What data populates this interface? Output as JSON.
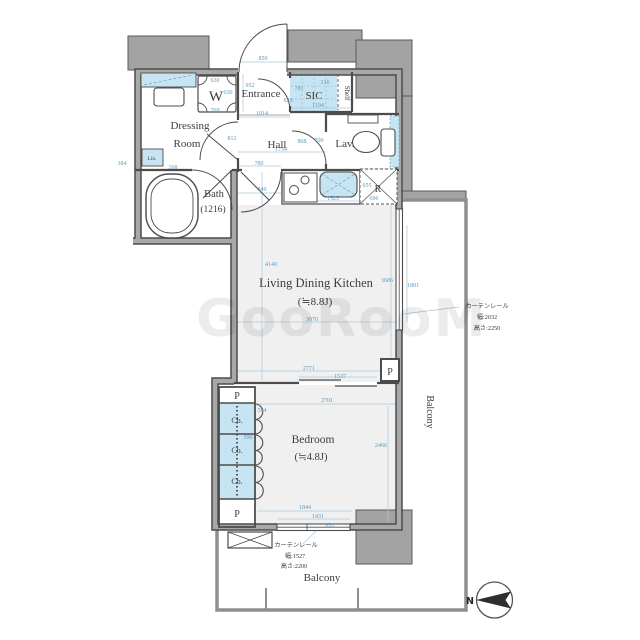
{
  "watermark": {
    "text": "GooRooM"
  },
  "colors": {
    "wall_edge": "#4c4c4c",
    "wall_fill": "#a8a8a8",
    "gray_block": "#a3a3a3",
    "fixture_blue": "#c7e4f2",
    "room_fill": "#f0f0f0",
    "dim_blue": "#5f98bc",
    "label_gray": "#3d3d3d",
    "balcony_line": "#8f8f8f"
  },
  "room_labels": [
    {
      "id": "entrance-label",
      "text": "Entrance",
      "x": 261,
      "y": 97,
      "size": 11
    },
    {
      "id": "sic-label",
      "text": "SIC",
      "x": 314,
      "y": 99,
      "size": 11
    },
    {
      "id": "shelf-label",
      "text": "Shelf",
      "x": 345,
      "y": 93,
      "size": 7,
      "rot": 90
    },
    {
      "id": "washer-label",
      "text": "W",
      "x": 216,
      "y": 101,
      "size": 15
    },
    {
      "id": "dressing-room-label-1",
      "text": "Dressing",
      "x": 190,
      "y": 129,
      "size": 11
    },
    {
      "id": "dressing-room-label-2",
      "text": "Room",
      "x": 187,
      "y": 147,
      "size": 11
    },
    {
      "id": "hall-label",
      "text": "Hall",
      "x": 277,
      "y": 148,
      "size": 11
    },
    {
      "id": "lavatory-label",
      "text": "Lav.",
      "x": 345,
      "y": 147,
      "size": 11
    },
    {
      "id": "linen-label",
      "text": "Lin.",
      "x": 152,
      "y": 160,
      "size": 5.5
    },
    {
      "id": "bath-label-1",
      "text": "Bath",
      "x": 214,
      "y": 197,
      "size": 10.5
    },
    {
      "id": "bath-label-2",
      "text": "(1216)",
      "x": 213,
      "y": 212,
      "size": 9.5
    },
    {
      "id": "ldk-label-1",
      "text": "Living Dining Kitchen",
      "x": 316,
      "y": 287,
      "size": 12.5
    },
    {
      "id": "ldk-label-2",
      "text": "(≒8.8J)",
      "x": 315,
      "y": 305,
      "size": 11
    },
    {
      "id": "bedroom-label-1",
      "text": "Bedroom",
      "x": 313,
      "y": 443,
      "size": 11.5
    },
    {
      "id": "bedroom-label-2",
      "text": "(≒4.8J)",
      "x": 311,
      "y": 460,
      "size": 10.5
    },
    {
      "id": "closet-label-1",
      "text": "Cb.",
      "x": 237,
      "y": 423,
      "size": 8
    },
    {
      "id": "closet-label-2",
      "text": "Cb.",
      "x": 237,
      "y": 453,
      "size": 8
    },
    {
      "id": "closet-label-3",
      "text": "Cb.",
      "x": 237,
      "y": 484,
      "size": 8
    },
    {
      "id": "pipe-space-ldk-label",
      "text": "P",
      "x": 390,
      "y": 375,
      "size": 10
    },
    {
      "id": "pipe-space-top-label",
      "text": "P",
      "x": 237,
      "y": 399,
      "size": 10
    },
    {
      "id": "pipe-space-bottom-label",
      "text": "P",
      "x": 237,
      "y": 517,
      "size": 10
    },
    {
      "id": "refrigerator-label",
      "text": "R",
      "x": 378,
      "y": 192,
      "size": 10
    },
    {
      "id": "balcony-right-label",
      "text": "Balcony",
      "x": 427,
      "y": 412,
      "size": 10,
      "rot": 90
    },
    {
      "id": "balcony-bottom-label",
      "text": "Balcony",
      "x": 322,
      "y": 581,
      "size": 11
    },
    {
      "id": "curtain-rail-right-1",
      "text": "カーテンレール",
      "x": 487,
      "y": 308,
      "size": 6.2
    },
    {
      "id": "curtain-rail-right-2",
      "text": "幅:2032",
      "x": 487,
      "y": 319,
      "size": 6.2
    },
    {
      "id": "curtain-rail-right-3",
      "text": "高さ:2250",
      "x": 487,
      "y": 330,
      "size": 6.2
    },
    {
      "id": "curtain-rail-bottom-1",
      "text": "カーテンレール",
      "x": 296,
      "y": 547,
      "size": 6.2
    },
    {
      "id": "curtain-rail-bottom-2",
      "text": "幅:1527",
      "x": 295,
      "y": 558,
      "size": 6.2
    },
    {
      "id": "curtain-rail-bottom-3",
      "text": "高さ:2200",
      "x": 294,
      "y": 568,
      "size": 6.2
    },
    {
      "id": "north-label",
      "text": "N",
      "x": 470,
      "y": 604,
      "size": 9.5,
      "cls": "north-lbl"
    }
  ],
  "dimensions": [
    {
      "v": "850",
      "x": 263,
      "y": 60
    },
    {
      "v": "952",
      "x": 250,
      "y": 87
    },
    {
      "v": "630",
      "x": 215,
      "y": 82
    },
    {
      "v": "630",
      "x": 228,
      "y": 94
    },
    {
      "v": "769",
      "x": 215,
      "y": 112
    },
    {
      "v": "781",
      "x": 299,
      "y": 90
    },
    {
      "v": "316",
      "x": 325,
      "y": 84
    },
    {
      "v": "629",
      "x": 288,
      "y": 102
    },
    {
      "v": "1194",
      "x": 318,
      "y": 107
    },
    {
      "v": "1014",
      "x": 262,
      "y": 115
    },
    {
      "v": "812",
      "x": 232,
      "y": 140
    },
    {
      "v": "868",
      "x": 302,
      "y": 143
    },
    {
      "v": "700",
      "x": 319,
      "y": 142
    },
    {
      "v": "1734",
      "x": 281,
      "y": 151
    },
    {
      "v": "780",
      "x": 259,
      "y": 165
    },
    {
      "v": "384",
      "x": 122,
      "y": 165
    },
    {
      "v": "268",
      "x": 173,
      "y": 169
    },
    {
      "v": "849",
      "x": 262,
      "y": 191
    },
    {
      "v": "1525",
      "x": 333,
      "y": 200
    },
    {
      "v": "655",
      "x": 367,
      "y": 187
    },
    {
      "v": "696",
      "x": 374,
      "y": 200
    },
    {
      "v": "4140",
      "x": 271,
      "y": 266
    },
    {
      "v": "3686",
      "x": 387,
      "y": 282
    },
    {
      "v": "1881",
      "x": 413,
      "y": 287
    },
    {
      "v": "3070",
      "x": 312,
      "y": 321
    },
    {
      "v": "2771",
      "x": 309,
      "y": 370
    },
    {
      "v": "1537",
      "x": 340,
      "y": 378
    },
    {
      "v": "2701",
      "x": 327,
      "y": 402
    },
    {
      "v": "584",
      "x": 262,
      "y": 412
    },
    {
      "v": "590",
      "x": 248,
      "y": 439
    },
    {
      "v": "2466",
      "x": 381,
      "y": 447
    },
    {
      "v": "1844",
      "x": 305,
      "y": 509
    },
    {
      "v": "1431",
      "x": 318,
      "y": 518
    },
    {
      "v": "831",
      "x": 330,
      "y": 527
    }
  ]
}
